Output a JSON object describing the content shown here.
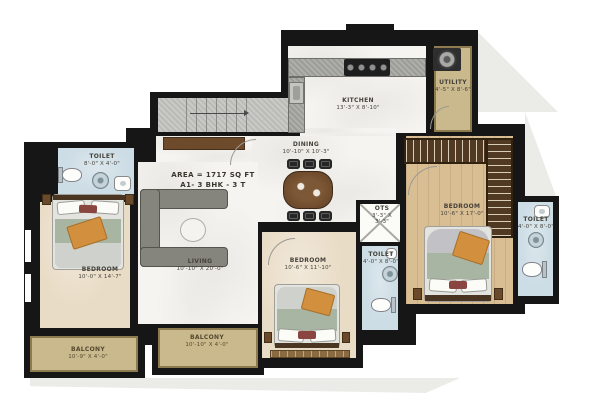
{
  "plan_title": "A1 - 3 BHK Floor Plan",
  "area": {
    "line1": "AREA = 1717 SQ FT",
    "line2": "A1- 3 BHK - 3 T"
  },
  "rooms": {
    "kitchen": {
      "name": "KITCHEN",
      "dims": "13'-3\" X 8'-10\""
    },
    "utility": {
      "name": "UTILITY",
      "dims": "4'-5\" X 8'-6\""
    },
    "dining": {
      "name": "DINING",
      "dims": "10'-10\" X 10'-3\""
    },
    "living": {
      "name": "LIVING",
      "dims": "10'-10\" X 20'-0\""
    },
    "toilet_left": {
      "name": "TOILET",
      "dims": "8'-0\" X 4'-0\""
    },
    "bedroom_left": {
      "name": "BEDROOM",
      "dims": "10'-0\" X 14'-7\""
    },
    "balcony_left": {
      "name": "BALCONY",
      "dims": "10'-9\" X 4'-0\""
    },
    "balcony_mid": {
      "name": "BALCONY",
      "dims": "10'-10\" X 4'-0\""
    },
    "bedroom_mid": {
      "name": "BEDROOM",
      "dims": "10'-6\" X 11'-10\""
    },
    "toilet_mid": {
      "name": "TOILET",
      "dims": "4'-0\" X 8'-0\""
    },
    "bedroom_right": {
      "name": "BEDROOM",
      "dims": "10'-6\" X 17'-0\""
    },
    "toilet_right": {
      "name": "TOILET",
      "dims": "4'-0\" X 8'-0\""
    },
    "ots": {
      "name": "OTS",
      "dims1": "3'-3\" X",
      "dims2": "3'-3\""
    }
  },
  "colors": {
    "wall": "#161616",
    "marble": "#f6f4f0",
    "beige": "#e9dcc6",
    "wood": "#d9bd93",
    "blue": "#cddde5",
    "tan": "#c9b98d",
    "granite": "#9c9c98",
    "table": "#6d4a2c",
    "sofa": "#85857d",
    "green": "#a9b5a3",
    "sheet": "#ced1cc",
    "orange": "#d28f3e",
    "wardrobe": "#513a23",
    "shadow": "#ebebe8",
    "label": "#45423a"
  }
}
